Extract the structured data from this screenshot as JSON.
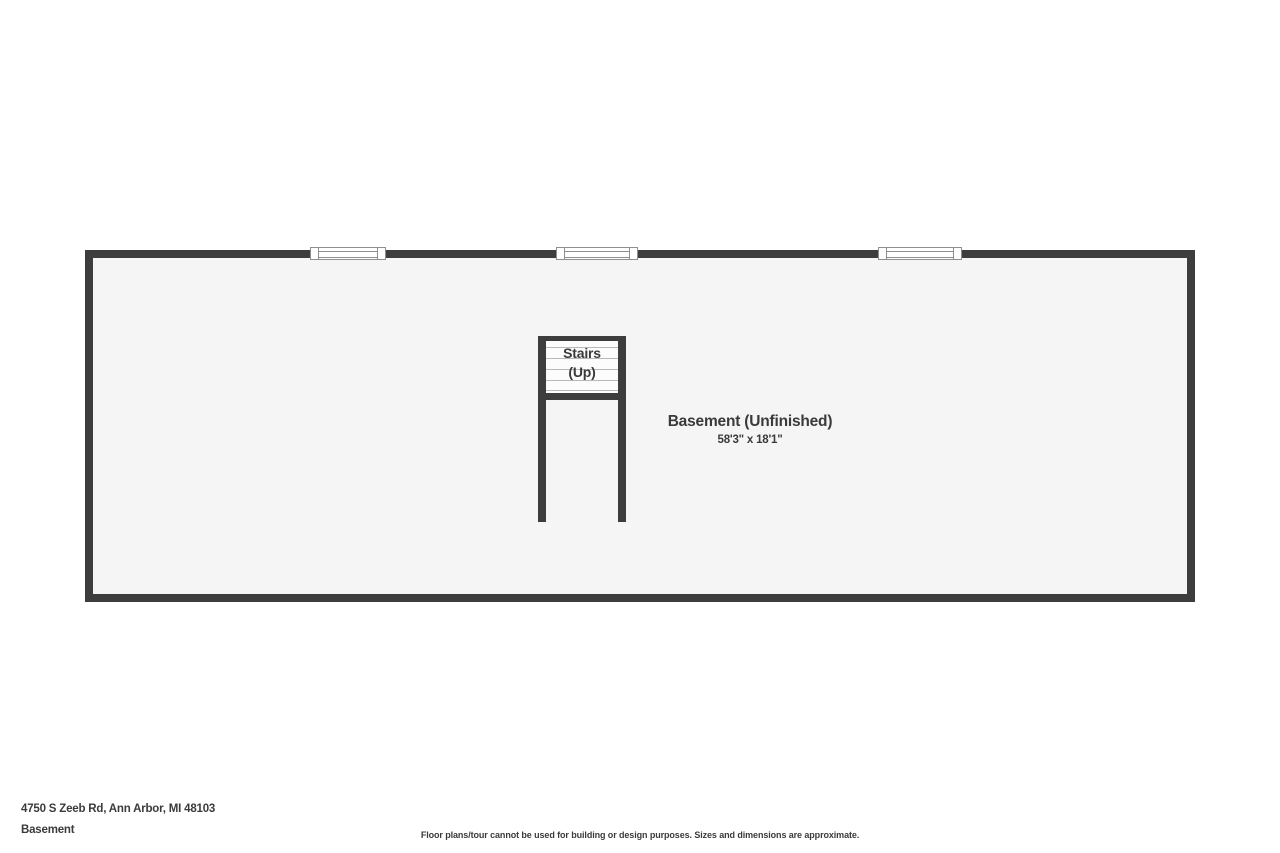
{
  "floor_plan": {
    "room": {
      "label": "Basement (Unfinished)",
      "dimensions": "58'3\" x 18'1\""
    },
    "stairs": {
      "line1": "Stairs",
      "line2": "(Up)"
    },
    "windows_count": 3,
    "colors": {
      "wall": "#3d3d3d",
      "floor": "#f5f5f5",
      "text": "#3a3a3a"
    }
  },
  "footer": {
    "address": "4750 S Zeeb Rd, Ann Arbor, MI 48103",
    "floor_name": "Basement",
    "disclaimer": "Floor plans/tour cannot be used for building or design purposes. Sizes and dimensions are approximate."
  }
}
